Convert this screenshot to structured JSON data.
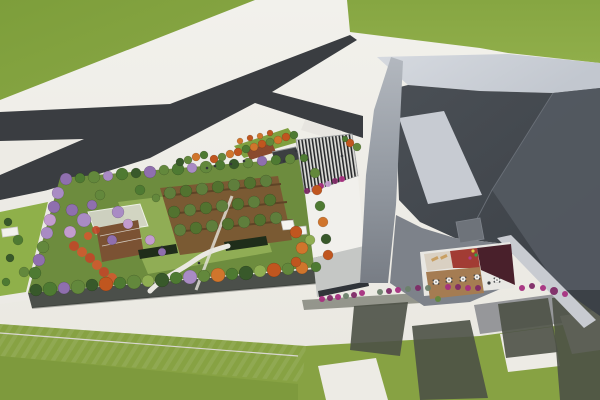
{
  "colors": {
    "pav": "#edebe5",
    "grassA": "#7d9e3b",
    "grassB": "#8aa845",
    "grassBottom": "#87a243",
    "grassBottomDark": "#7c983c",
    "road": "#3a3d41",
    "roadBR": "#96979a",
    "crosswalk": "#e6e4de",
    "gardenBase": "#6d8c3e",
    "lawn": "#90ad55",
    "orchardSoil": "#7a5a33",
    "orchardLine": "#5e4426",
    "facade": "#4b4f4a",
    "pathW": "#eae8e2",
    "hedge": "#1f2d1a",
    "flowerRed": "#c14628",
    "flowerRed2": "#d2592f",
    "pergFrame": "#dedcd6",
    "pergDeck": "#7b5233",
    "plazaLawn": "#7fa03f",
    "deckRed": "#8a4a2e",
    "shelter": "#3c3f41",
    "canopyDark": "#27292b",
    "canopyLight": "#dcdcd8",
    "annexWhite": "#f1f0ec",
    "annexRoof": "#c5c7c5",
    "annexDark": "#303439",
    "kiosk": "#f4f3f0",
    "roofLight1": "#d6dae0",
    "roofLight2": "#c2c7cf",
    "darkMass1": "#43484e",
    "darkMass2": "#3c4147",
    "facetR": "#545a62",
    "ridge": "#6a7078",
    "skylight": "#c7cbd2",
    "fin1": "#b3b8bf",
    "fin2": "#787d85",
    "wallBand": "#c8cbd1",
    "apron": "#7d828a",
    "vent": "#6e737a",
    "cream": "#d9d0c2",
    "redFloor": "#a23c34",
    "maroon": "#49202b",
    "tanFloor": "#a57c52",
    "rimWhite": "#e8e7e3",
    "lounger": "#c9a063",
    "shadow": "#4d5146",
    "tableW": "#f2f2f0",
    "tableDark": "#3a3d40",
    "people": "#33363a",
    "joint": "#d9d7d1",
    "g1": "#4e7a32",
    "g2": "#63883c",
    "g3": "#38592a",
    "lg": "#8fae52",
    "og": "#5f7e3c",
    "og2": "#52722f",
    "o1": "#c0561f",
    "o2": "#d0752c",
    "p1": "#8f6fae",
    "p2": "#a98bc4",
    "pk": "#c39ccf",
    "mg1": "#a62f80",
    "mg2": "#7e2a66",
    "gb": "#6b7f6a"
  },
  "scene": {
    "trees": [
      [
        66,
        179,
        6,
        "p1"
      ],
      [
        80,
        178,
        5,
        "g1"
      ],
      [
        94,
        177,
        6,
        "g2"
      ],
      [
        108,
        176,
        5,
        "p2"
      ],
      [
        122,
        174,
        6,
        "g1"
      ],
      [
        136,
        173,
        5,
        "g3"
      ],
      [
        150,
        172,
        6,
        "p1"
      ],
      [
        164,
        170,
        5,
        "g2"
      ],
      [
        178,
        169,
        6,
        "g1"
      ],
      [
        192,
        168,
        5,
        "p2"
      ],
      [
        206,
        167,
        6,
        "g2"
      ],
      [
        220,
        165,
        5,
        "g1"
      ],
      [
        234,
        164,
        5,
        "g3"
      ],
      [
        248,
        163,
        5,
        "g2"
      ],
      [
        262,
        161,
        5,
        "p1"
      ],
      [
        276,
        160,
        5,
        "g1"
      ],
      [
        290,
        159,
        5,
        "g2"
      ],
      [
        304,
        158,
        4,
        "g1"
      ],
      [
        315,
        173,
        5,
        "g2"
      ],
      [
        317,
        190,
        5,
        "o1"
      ],
      [
        320,
        206,
        5,
        "g1"
      ],
      [
        323,
        222,
        5,
        "o2"
      ],
      [
        326,
        239,
        5,
        "g3"
      ],
      [
        328,
        255,
        5,
        "o1"
      ],
      [
        36,
        290,
        6,
        "g3"
      ],
      [
        50,
        289,
        7,
        "g1"
      ],
      [
        64,
        288,
        6,
        "p1"
      ],
      [
        78,
        287,
        7,
        "g2"
      ],
      [
        92,
        285,
        6,
        "g3"
      ],
      [
        106,
        284,
        7,
        "o1"
      ],
      [
        120,
        283,
        6,
        "g1"
      ],
      [
        134,
        282,
        7,
        "g2"
      ],
      [
        148,
        281,
        6,
        "lg"
      ],
      [
        162,
        280,
        7,
        "g3"
      ],
      [
        176,
        278,
        6,
        "g1"
      ],
      [
        190,
        277,
        7,
        "p2"
      ],
      [
        204,
        276,
        6,
        "g2"
      ],
      [
        218,
        275,
        7,
        "o2"
      ],
      [
        232,
        274,
        6,
        "g1"
      ],
      [
        246,
        273,
        7,
        "g3"
      ],
      [
        260,
        271,
        6,
        "lg"
      ],
      [
        274,
        270,
        7,
        "o1"
      ],
      [
        288,
        269,
        6,
        "g2"
      ],
      [
        302,
        268,
        6,
        "o2"
      ],
      [
        316,
        267,
        5,
        "g1"
      ],
      [
        58,
        193,
        6,
        "p2"
      ],
      [
        54,
        207,
        6,
        "p1"
      ],
      [
        50,
        220,
        6,
        "pk"
      ],
      [
        47,
        233,
        6,
        "p2"
      ],
      [
        43,
        247,
        6,
        "g2"
      ],
      [
        39,
        260,
        6,
        "p1"
      ],
      [
        35,
        273,
        6,
        "g1"
      ],
      [
        72,
        210,
        6,
        "p1"
      ],
      [
        84,
        220,
        7,
        "p2"
      ],
      [
        70,
        232,
        6,
        "pk"
      ],
      [
        92,
        205,
        5,
        "p1"
      ],
      [
        118,
        212,
        6,
        "p2"
      ],
      [
        128,
        224,
        5,
        "pk"
      ],
      [
        112,
        240,
        5,
        "p1"
      ],
      [
        170,
        193,
        6,
        "og"
      ],
      [
        186,
        191,
        6,
        "og2"
      ],
      [
        202,
        189,
        6,
        "og"
      ],
      [
        218,
        187,
        6,
        "og2"
      ],
      [
        234,
        185,
        6,
        "og"
      ],
      [
        250,
        183,
        6,
        "og2"
      ],
      [
        266,
        181,
        6,
        "og"
      ],
      [
        174,
        212,
        6,
        "og2"
      ],
      [
        190,
        210,
        6,
        "og"
      ],
      [
        206,
        208,
        6,
        "og2"
      ],
      [
        222,
        206,
        6,
        "og"
      ],
      [
        238,
        204,
        6,
        "og2"
      ],
      [
        254,
        202,
        6,
        "og"
      ],
      [
        270,
        200,
        6,
        "og2"
      ],
      [
        180,
        230,
        6,
        "og"
      ],
      [
        196,
        228,
        6,
        "og2"
      ],
      [
        212,
        226,
        6,
        "og"
      ],
      [
        228,
        224,
        6,
        "og2"
      ],
      [
        244,
        222,
        6,
        "og"
      ],
      [
        260,
        220,
        6,
        "og2"
      ],
      [
        276,
        218,
        6,
        "og"
      ],
      [
        296,
        232,
        6,
        "o1"
      ],
      [
        302,
        248,
        6,
        "o2"
      ],
      [
        296,
        262,
        5,
        "o1"
      ],
      [
        310,
        240,
        5,
        "lg"
      ],
      [
        150,
        240,
        5,
        "pk"
      ],
      [
        162,
        252,
        4,
        "p1"
      ],
      [
        100,
        195,
        5,
        "g2"
      ],
      [
        140,
        190,
        5,
        "g1"
      ],
      [
        156,
        198,
        4,
        "g2"
      ],
      [
        8,
        222,
        4,
        "g3"
      ],
      [
        18,
        240,
        5,
        "g1"
      ],
      [
        10,
        258,
        4,
        "g3"
      ],
      [
        24,
        272,
        5,
        "g2"
      ],
      [
        6,
        282,
        4,
        "g1"
      ],
      [
        214,
        159,
        4,
        "o1"
      ],
      [
        222,
        157,
        4,
        "g2"
      ],
      [
        230,
        154,
        4,
        "o2"
      ],
      [
        238,
        152,
        4,
        "o1"
      ],
      [
        246,
        149,
        4,
        "g1"
      ],
      [
        254,
        147,
        4,
        "o2"
      ],
      [
        262,
        144,
        4,
        "o1"
      ],
      [
        270,
        142,
        4,
        "g2"
      ],
      [
        278,
        140,
        4,
        "o2"
      ],
      [
        286,
        137,
        4,
        "o1"
      ],
      [
        294,
        135,
        4,
        "g1"
      ],
      [
        240,
        141,
        3,
        "o2"
      ],
      [
        250,
        138,
        3,
        "o1"
      ],
      [
        260,
        136,
        3,
        "o2"
      ],
      [
        270,
        133,
        3,
        "o1"
      ],
      [
        188,
        160,
        4,
        "g2"
      ],
      [
        196,
        157,
        4,
        "o2"
      ],
      [
        204,
        155,
        4,
        "g1"
      ],
      [
        180,
        162,
        4,
        "g3"
      ],
      [
        350,
        143,
        4,
        "o1"
      ],
      [
        357,
        147,
        4,
        "g2"
      ],
      [
        345,
        139,
        3,
        "g1"
      ]
    ],
    "bushes": [
      [
        307,
        191,
        3,
        "mg2"
      ],
      [
        314,
        189,
        3,
        "pk"
      ],
      [
        321,
        186,
        3,
        "mg1"
      ],
      [
        328,
        184,
        3,
        "pk"
      ],
      [
        335,
        181,
        3,
        "mg2"
      ],
      [
        342,
        179,
        3,
        "mg1"
      ],
      [
        322,
        299,
        3,
        "mg1"
      ],
      [
        330,
        298,
        3,
        "mg2"
      ],
      [
        338,
        297,
        3,
        "mg1"
      ],
      [
        346,
        296,
        3,
        "gb"
      ],
      [
        354,
        295,
        3,
        "mg2"
      ],
      [
        362,
        293,
        3,
        "mg1"
      ],
      [
        380,
        292,
        3,
        "gb"
      ],
      [
        389,
        291,
        3,
        "mg2"
      ],
      [
        398,
        290,
        3,
        "mg1"
      ],
      [
        408,
        289,
        3,
        "gb"
      ],
      [
        418,
        288,
        3,
        "mg2"
      ],
      [
        428,
        288,
        3,
        "gb"
      ],
      [
        438,
        299,
        3,
        "g2"
      ],
      [
        448,
        287,
        3,
        "mg1"
      ],
      [
        458,
        287,
        3,
        "mg2"
      ],
      [
        468,
        288,
        3,
        "mg1"
      ],
      [
        478,
        288,
        3,
        "mg2"
      ],
      [
        522,
        288,
        3,
        "mg1"
      ],
      [
        532,
        286,
        3,
        "mg2"
      ],
      [
        543,
        288,
        3,
        "mg1"
      ],
      [
        554,
        291,
        4,
        "mg2"
      ],
      [
        565,
        294,
        3,
        "mg1"
      ]
    ],
    "flower_bed": [
      [
        74,
        246,
        5
      ],
      [
        82,
        252,
        5
      ],
      [
        90,
        258,
        5
      ],
      [
        97,
        265,
        5
      ],
      [
        104,
        272,
        5
      ],
      [
        112,
        278,
        5
      ],
      [
        120,
        283,
        4
      ],
      [
        88,
        236,
        4
      ],
      [
        96,
        230,
        4
      ]
    ],
    "people": [
      [
        207,
        168
      ],
      [
        215,
        166
      ],
      [
        296,
        151
      ],
      [
        304,
        153
      ],
      [
        284,
        161
      ],
      [
        244,
        161
      ],
      [
        231,
        164
      ],
      [
        199,
        263
      ],
      [
        162,
        247
      ],
      [
        342,
        156
      ]
    ],
    "courtyard_figures": [
      [
        473,
        251,
        "#d9ca3e"
      ],
      [
        476,
        255,
        "#3a9d46"
      ],
      [
        470,
        258,
        "#b03a8c"
      ],
      [
        489,
        283,
        "#3a3d40"
      ]
    ],
    "tables": [
      [
        436,
        282
      ],
      [
        449,
        280
      ],
      [
        463,
        279
      ],
      [
        477,
        277
      ],
      [
        497,
        280
      ]
    ],
    "loungers": [
      [
        431,
        259
      ],
      [
        440,
        257
      ]
    ]
  }
}
